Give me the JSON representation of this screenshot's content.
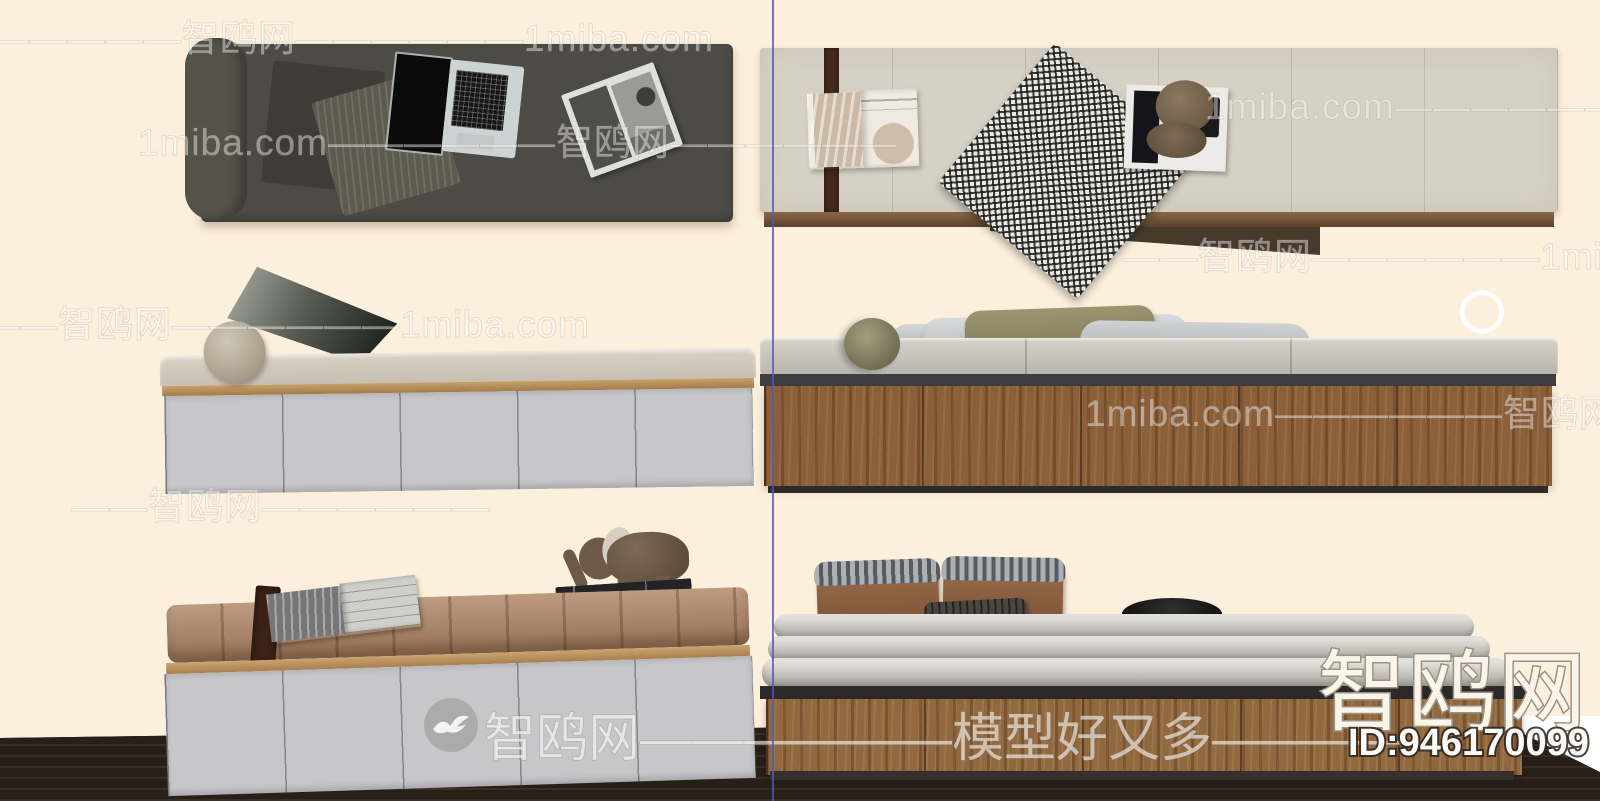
{
  "site": {
    "name_cn": "智鸥网",
    "domain": "1miba.com",
    "slogan": "模型好又多",
    "model_id": "ID:946170099"
  },
  "watermarks": {
    "tiled_rows": [
      {
        "text": "—————智鸥网——————1miba.com",
        "x": -8,
        "y": 8
      },
      {
        "text": "1miba.com——————智鸥网—",
        "x": 1205,
        "y": 76
      },
      {
        "text": "1miba.com——————智鸥网——————",
        "x": 138,
        "y": 112
      },
      {
        "text": "——智鸥网——————1miba.com——",
        "x": 1122,
        "y": 226
      },
      {
        "text": "——————智鸥网——————1miba.com",
        "x": -170,
        "y": 294
      },
      {
        "text": "1miba.com——————智鸥网——",
        "x": 1085,
        "y": 383
      },
      {
        "text": "——智鸥网——————",
        "x": 72,
        "y": 476
      }
    ],
    "center_banner": {
      "logo": "seagull-logo",
      "text": "智鸥网——————模型好又多————"
    },
    "corner": {
      "logo_text": "智鸥网",
      "id_text": "ID:946170099"
    }
  },
  "scene": {
    "background_color": "#fcefdc",
    "floor_color": "#262019",
    "divider_line_color": "#5555be",
    "models": [
      {
        "name": "storage-bed-dark-top-view",
        "position": "top-left",
        "base_color": "#4c4b45",
        "props": [
          "bolster-pillow",
          "dark-pillow",
          "striped-pillow",
          "open-laptop",
          "magazine"
        ]
      },
      {
        "name": "storage-bed-light-top-view",
        "position": "top-right",
        "base_color": "#d7d1c5",
        "props": [
          "brown-ribbon",
          "open-magazine",
          "houndstooth-throw",
          "magazine-with-hat"
        ]
      },
      {
        "name": "storage-bed-grey-cabinet-front",
        "position": "middle-left",
        "base_color": "#c7c6c9",
        "props": [
          "bolster-pillow",
          "leaning-pillow"
        ]
      },
      {
        "name": "storage-bed-wood-cabinet-front",
        "position": "middle-right",
        "base_color": "#8a5f3a",
        "props": [
          "olive-bolster",
          "grey-pillows",
          "olive-pillow"
        ]
      },
      {
        "name": "storage-bed-tufted-mattress",
        "position": "bottom-left",
        "base_color": "#aa805f",
        "props": [
          "brown-ribbon",
          "open-magazine",
          "elephant-figurine",
          "book-stack"
        ]
      },
      {
        "name": "storage-bed-layered-mattress",
        "position": "bottom-right",
        "base_color": "#916940",
        "props": [
          "brown-pillows",
          "striped-lumbar-pillow",
          "round-black-cushion"
        ]
      }
    ]
  }
}
